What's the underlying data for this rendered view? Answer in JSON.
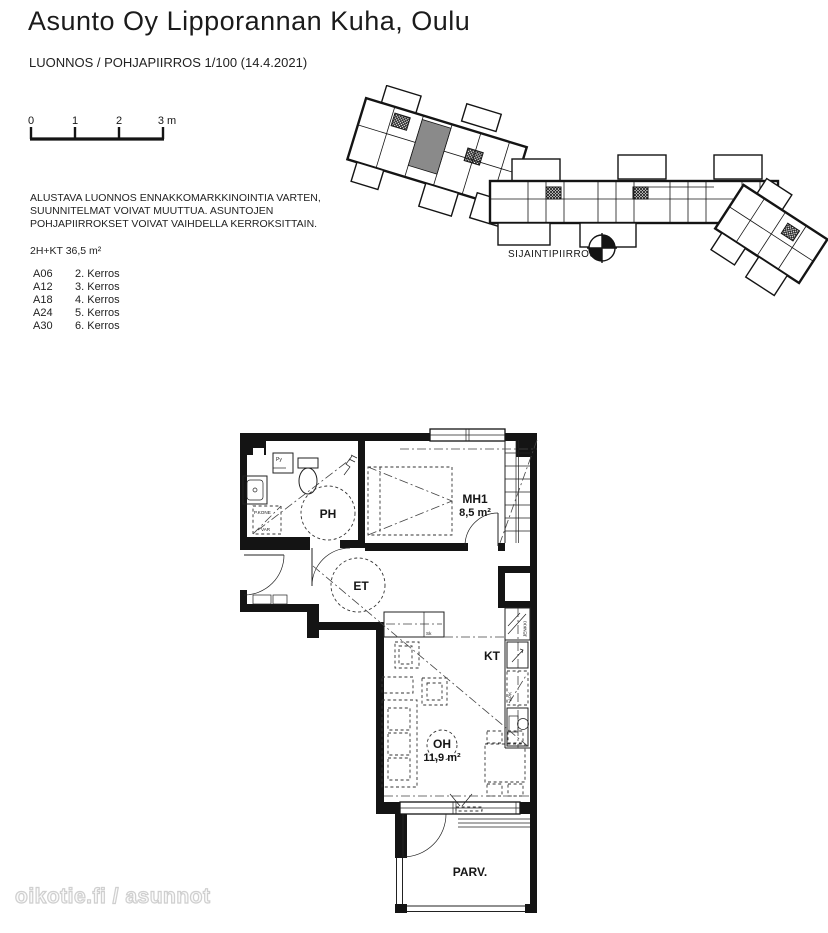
{
  "header": {
    "title": "Asunto Oy Lipporannan Kuha, Oulu",
    "subtitle": "LUONNOS / POHJAPIIRROS 1/100 (14.4.2021)"
  },
  "scale_bar": {
    "ticks": [
      "0",
      "1",
      "2",
      "3 m"
    ]
  },
  "disclaimer": {
    "line1": "ALUSTAVA LUONNOS ENNAKKOMARKKINOINTIA VARTEN,",
    "line2": "SUUNNITELMAT VOIVAT MUUTTUA. ASUNTOJEN",
    "line3": "POHJAPIIRROKSET VOIVAT VAIHDELLA KERROKSITTAIN."
  },
  "apartment": {
    "type_label": "2H+KT 36,5 m²"
  },
  "apartments": [
    {
      "unit": "A06",
      "floor": "2. Kerros"
    },
    {
      "unit": "A12",
      "floor": "3. Kerros"
    },
    {
      "unit": "A18",
      "floor": "4. Kerros"
    },
    {
      "unit": "A24",
      "floor": "5. Kerros"
    },
    {
      "unit": "A30",
      "floor": "6. Kerros"
    }
  ],
  "site_plan": {
    "label": "SIJAINTIPIIRROS"
  },
  "floor_plan": {
    "rooms": {
      "ph": "PH",
      "mh1": "MH1",
      "mh1_area": "8,5 m²",
      "et": "ET",
      "kt": "KT",
      "oh": "OH",
      "oh_area": "11,9 m²",
      "parv": "PARV."
    },
    "fixtures": {
      "py": "Py",
      "pkone": "P.KONE",
      "var": "VAR",
      "sk": "Sk",
      "jenkki": "JENKKI",
      "apk": "APK"
    }
  },
  "watermark": "oikotie.fi / asunnot",
  "colors": {
    "highlight_unit": "#8a8a8a",
    "wall": "#141414"
  }
}
